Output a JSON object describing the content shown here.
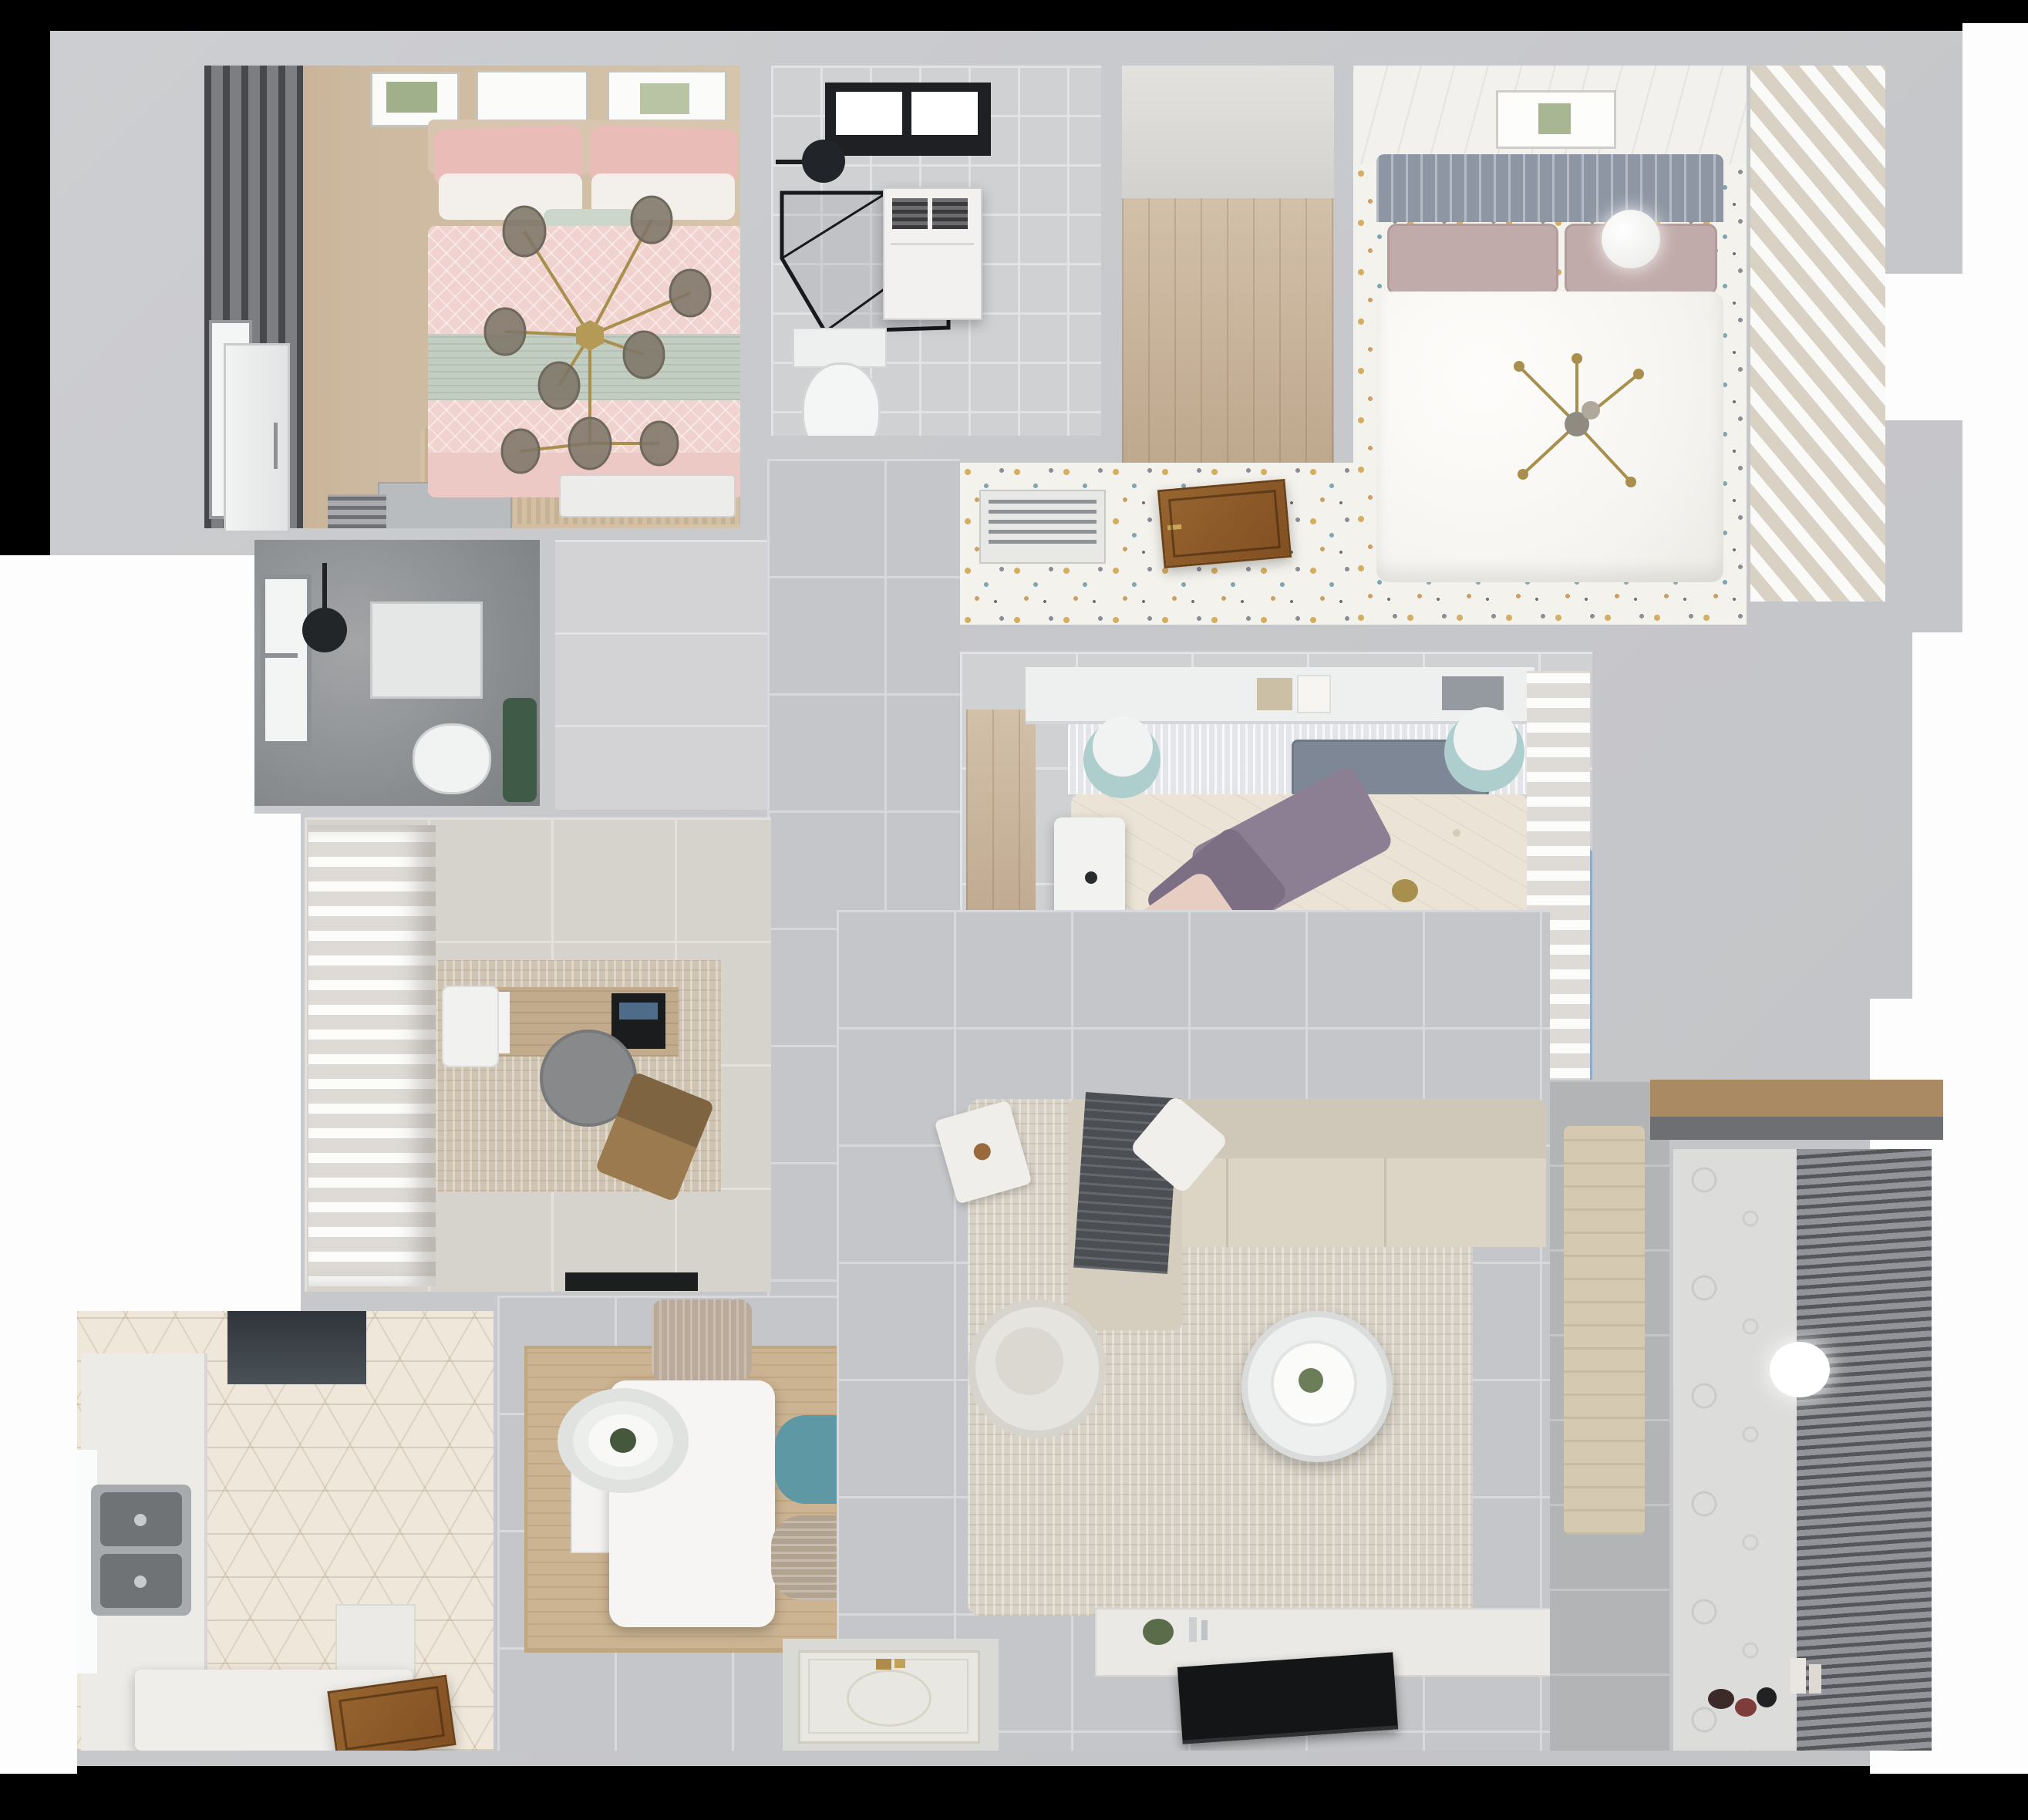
{
  "scene": {
    "type": "3d-floorplan-top-view-render",
    "description": "Photorealistic top-down 3D render of an apartment floor plan, no visible text",
    "background": "#000000"
  },
  "palette": {
    "page_background": "#000000",
    "outside_white": "#fdfdfd",
    "wall": "#c8c9cc",
    "tile_gray": "#c5c6c9",
    "tile_light": "#d0d1d3",
    "dark_stone": "#8d9093",
    "wood_floor": "#c9b296",
    "hex_tile_cream": "#efe7da",
    "confetti_floor": "#f4f2ed",
    "pink_duvet": "#f0d2ce",
    "sage_throw": "#c3cec3",
    "headboard_blue": "#8e96a4",
    "mauve_pillow": "#c0abaa",
    "purple_pillow": "#8d7f93",
    "teal_chair": "#5f98a5",
    "rug_beige": "#d8d1c5",
    "rug_rose": "#b08286",
    "rug_blue": "#7fa3cc",
    "rug_teal": "#7c9aa4",
    "gold_accent": "#a98f4e",
    "door_wood": "#8a5a2b",
    "tv_black": "#141517"
  },
  "rooms": {
    "pink_bedroom": {
      "name": "pink bedroom (top-left)",
      "furniture": [
        "double-bed-pink",
        "gold-branch-chandelier",
        "dark-window-curtains",
        "picture-frames",
        "nightstand",
        "radiator",
        "foot-bench",
        "white-door"
      ]
    },
    "bathroom_top": {
      "name": "bathroom with skylight (top-center)",
      "furniture": [
        "skylight",
        "shower-head",
        "glass-shower-enclosure",
        "towel-cabinet",
        "toilet"
      ]
    },
    "walkin_closet": {
      "name": "walk-in closet with wood floor",
      "furniture": [
        "wood-floor",
        "open-wood-door"
      ]
    },
    "white_bedroom": {
      "name": "white bedroom (top-right)",
      "furniture": [
        "double-bed-white",
        "slat-headboard",
        "sputnik-chandelier",
        "ball-lamp",
        "slatted-closet",
        "panel-ceiling",
        "picture-frame",
        "ac-vent"
      ]
    },
    "shower_room": {
      "name": "dark shower room (mid-left)",
      "furniture": [
        "window",
        "ceiling-shower-head",
        "shower-mat",
        "toilet",
        "plant"
      ]
    },
    "study": {
      "name": "study (center-left)",
      "furniture": [
        "white-curtains",
        "area-rug",
        "wood-desk",
        "laptop",
        "desk-chair-round",
        "white-chair",
        "lounge-chair",
        "doormat"
      ]
    },
    "center_bedroom": {
      "name": "center bedroom",
      "furniture": [
        "canopy-bed",
        "floral-duvet",
        "purple-pillows",
        "wall-shelf-books",
        "white-desk",
        "teal-poufs",
        "round-rugs",
        "white-curtains",
        "wardrobe-niche",
        "foot-bench"
      ]
    },
    "hallway": {
      "name": "hallway / corridor",
      "furniture": []
    },
    "kitchen": {
      "name": "kitchen (bottom-left)",
      "furniture": [
        "range-hood",
        "double-sink",
        "counter",
        "island",
        "window",
        "wood-door",
        "hex-tile-floor"
      ]
    },
    "dining": {
      "name": "dining area",
      "furniture": [
        "white-table",
        "oval-pendant-lamp",
        "beige-chairs",
        "teal-chair",
        "bench",
        "wood-mat"
      ]
    },
    "living": {
      "name": "living room",
      "furniture": [
        "sectional-sofa",
        "dark-throw",
        "round-armchair",
        "side-table",
        "round-coffee-table",
        "tv-console",
        "flat-tv",
        "area-rug"
      ]
    },
    "balcony": {
      "name": "balcony / laundry (bottom-right)",
      "furniture": [
        "dark-blinds",
        "patterned-tile-wall",
        "ball-lamp",
        "toys",
        "wood-shelf",
        "towel"
      ]
    },
    "entry": {
      "name": "entry",
      "furniture": [
        "ornate-door-mat",
        "gold-handles"
      ]
    }
  }
}
